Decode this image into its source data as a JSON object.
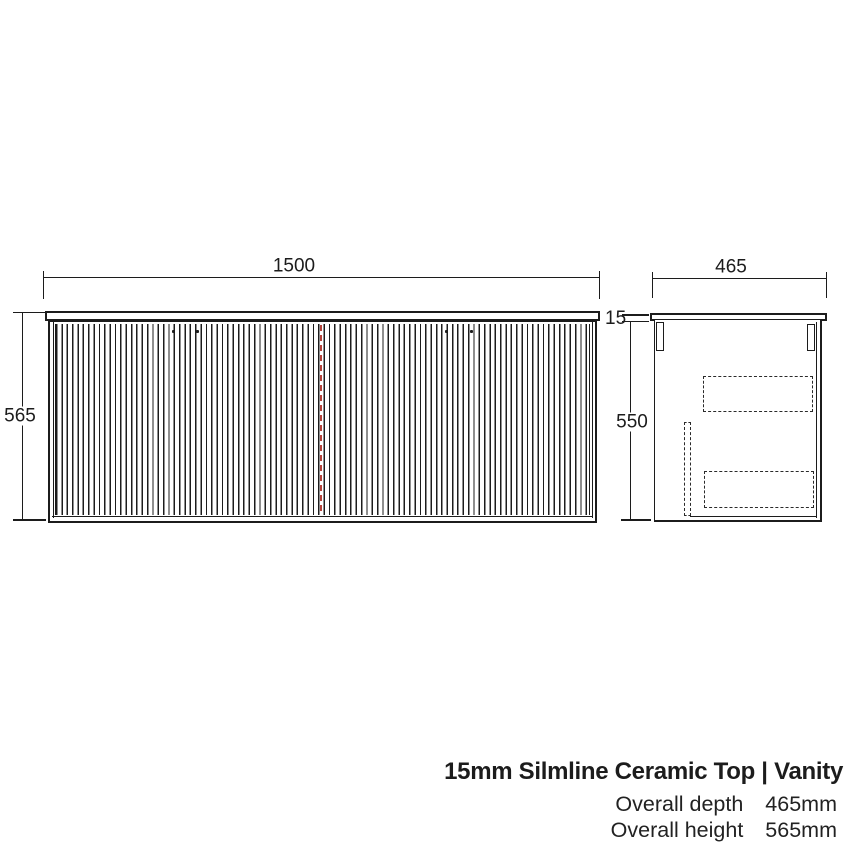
{
  "drawing": {
    "front_view": {
      "width_dim": "1500",
      "height_dim": "565"
    },
    "side_view": {
      "depth_dim": "465",
      "top_thickness_dim": "15",
      "body_height_dim": "550"
    },
    "colors": {
      "line": "#1c1c1c",
      "door_split": "#b5443c"
    }
  },
  "footer": {
    "title": "15mm Silmline Ceramic Top | Vanity",
    "specs": [
      {
        "label": "Overall depth",
        "value": "465mm"
      },
      {
        "label": "Overall height",
        "value": "565mm"
      }
    ]
  }
}
